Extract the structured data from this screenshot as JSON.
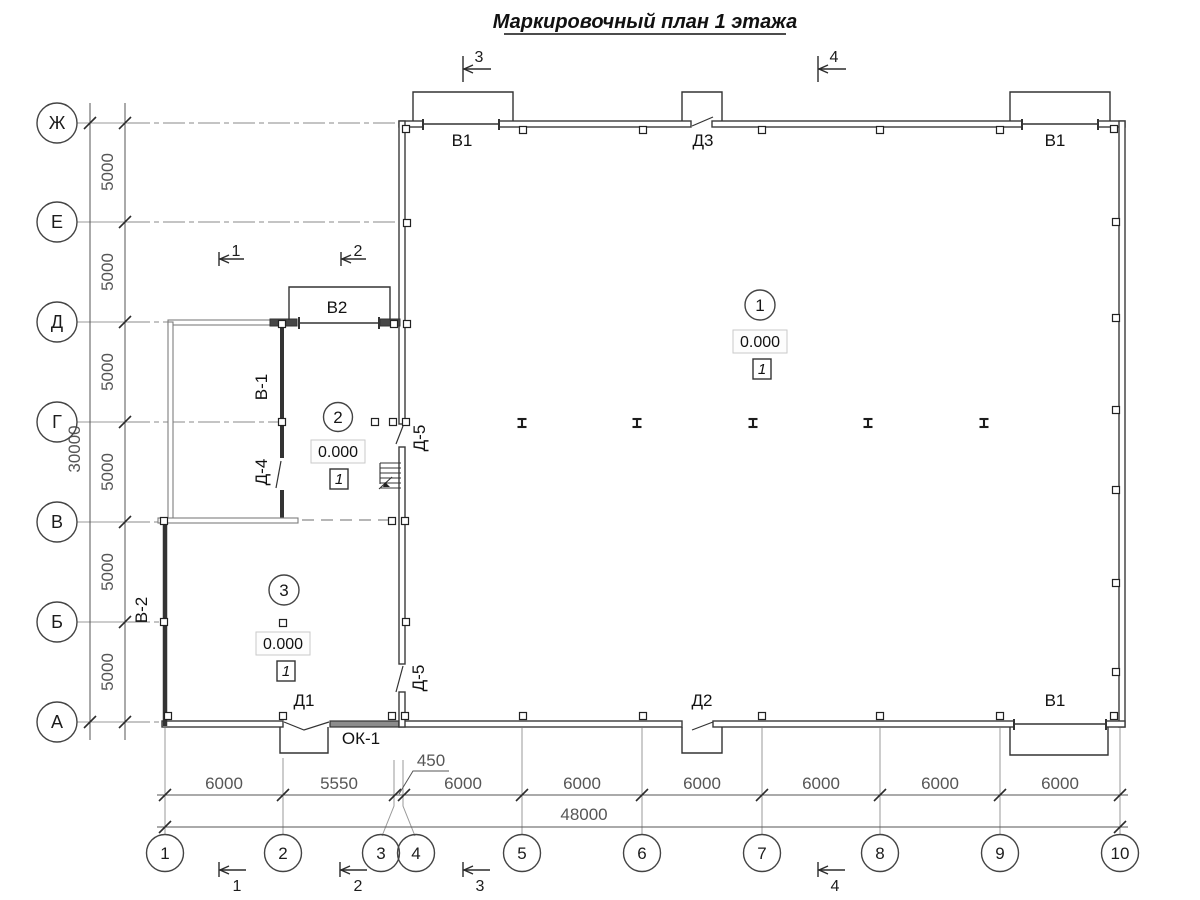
{
  "title": "Маркировочный план 1 этажа",
  "grid": {
    "row_labels": [
      "Ж",
      "Е",
      "Д",
      "Г",
      "В",
      "Б",
      "А"
    ],
    "col_labels": [
      "1",
      "2",
      "3",
      "4",
      "5",
      "6",
      "7",
      "8",
      "9",
      "10"
    ]
  },
  "dimensions": {
    "row_spacing": [
      "5000",
      "5000",
      "5000",
      "5000",
      "5000",
      "5000"
    ],
    "row_total": "30000",
    "col_spacing": [
      "6000",
      "5550",
      "450",
      "6000",
      "6000",
      "6000",
      "6000",
      "6000",
      "6000"
    ],
    "col_total": "48000"
  },
  "openings": {
    "top_gate_left": "В1",
    "top_door": "Д3",
    "top_gate_right": "В1",
    "annex_gate": "В2",
    "annex_inner_gate": "В-1",
    "annex_door": "Д-4",
    "hall_door_upper": "Д-5",
    "hall_door_lower": "Д-5",
    "west_gate": "В-2",
    "entry_door": "Д1",
    "window": "ОК-1",
    "south_door": "Д2",
    "south_gate": "В1"
  },
  "rooms": [
    {
      "number": "1",
      "elevation": "0.000",
      "finish_type": "1"
    },
    {
      "number": "2",
      "elevation": "0.000",
      "finish_type": "1"
    },
    {
      "number": "3",
      "elevation": "0.000",
      "finish_type": "1"
    }
  ],
  "sections": {
    "top": [
      "3",
      "4"
    ],
    "middle": [
      "1",
      "2"
    ],
    "bottom": [
      "1",
      "2",
      "3",
      "4"
    ]
  }
}
